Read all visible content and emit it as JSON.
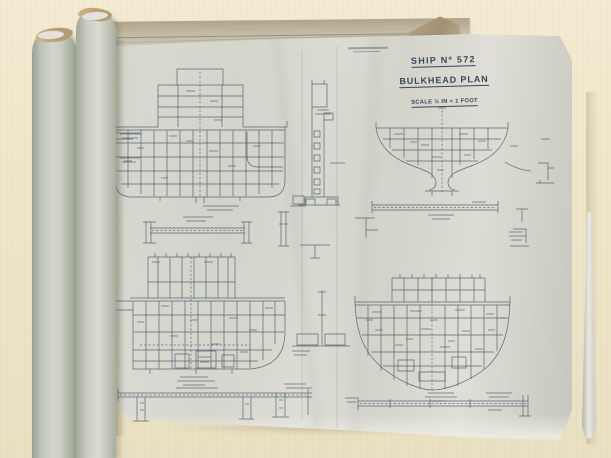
{
  "sheet": {
    "title_block": {
      "ship_no": "SHIP Nº 572",
      "plan_name": "BULKHEAD PLAN",
      "scale": "SCALE ½ IN = 1 FOOT"
    }
  },
  "colors": {
    "table_surface": "#efe5c9",
    "paper_sheet": "#d9d9d1",
    "under_sheet": "#c2bca7",
    "kraft_edge": "#b49c72",
    "drawing_ink": "#4e5a68",
    "title_ink": "#39475a",
    "roll_grey": "#c7cbc0",
    "roll_white": "#ececе6"
  }
}
